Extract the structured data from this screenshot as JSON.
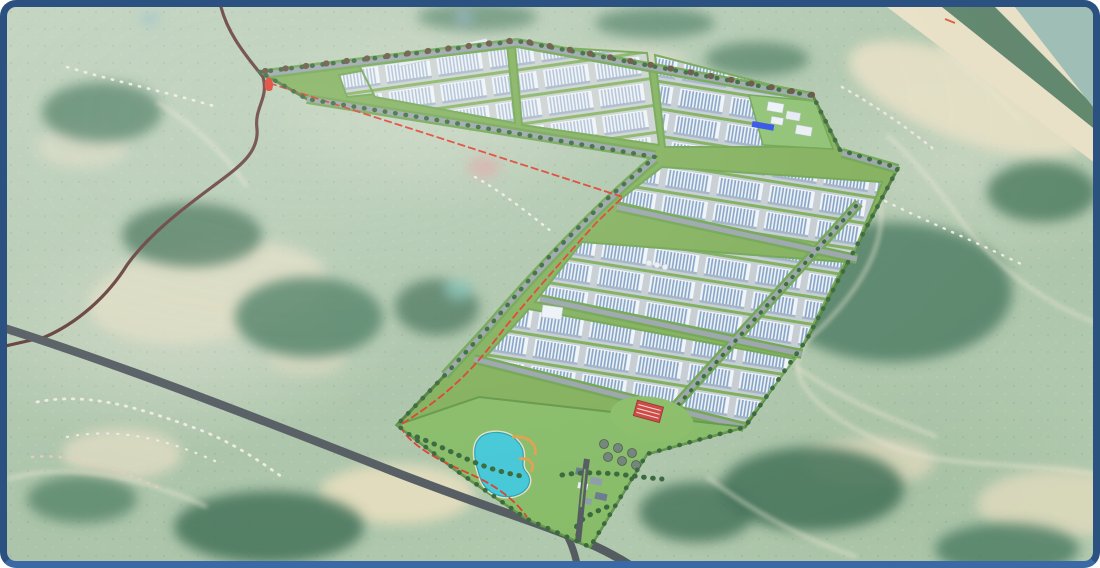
{
  "scene": {
    "label": "aerial-industrial-park-masterplan-render",
    "elements": [
      "satellite-terrain",
      "industrial-park",
      "warehouse-rows",
      "utility-campus",
      "landscaped-lake-park",
      "entrance-interchange",
      "winding-mountain-road",
      "highway",
      "coastline"
    ]
  },
  "colors": {
    "frame_border": "#2b5181",
    "frame_border_bottom": "#3a69a5",
    "terrain_base": "#b3c9ae",
    "forest": "#47785a",
    "field": "#e3ddc0",
    "sea": "#9bbcb2",
    "sand": "#ece2c4",
    "coastal_trees": "#3f6e52",
    "park_green": "#7fae52",
    "amenity_green": "#84ba5f",
    "roof_white": "#f4f7fa",
    "roof_stripe_blue": "#7e9dc2",
    "road_gray": "#9aa1a8",
    "highway": "#4c5258",
    "brown_road": "#5e332e",
    "rural_road": "#efe9d2",
    "red_line": "#e23322",
    "lake": "#3cc7d6",
    "blue_roof": "#2547e8",
    "red_building": "#cf3b35",
    "tree_dark": "#2f6030"
  }
}
